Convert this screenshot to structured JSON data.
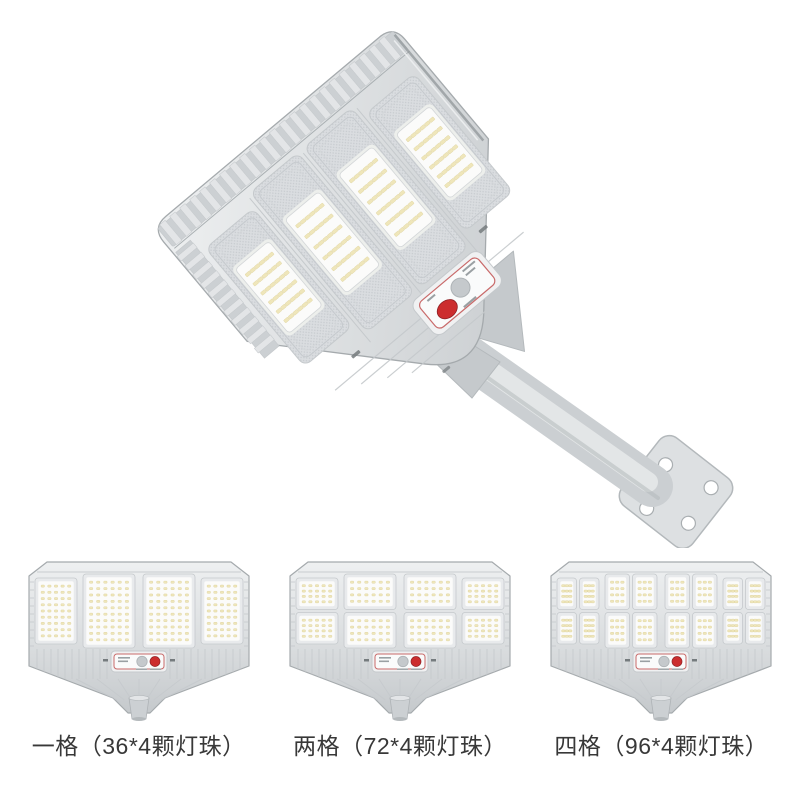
{
  "background": "#ffffff",
  "colors": {
    "body": "#d8dbdd",
    "body_shade": "#c5c9cc",
    "body_dark": "#aab0b3",
    "body_light": "#eef0f1",
    "outline": "#a5aaad",
    "rim_slot": "#8d9396",
    "fin_light": "#e3e5e7",
    "fin_band": "#ccd0d3",
    "knurl_bg": "#dadde0",
    "knurl_dot": "#c6cace",
    "module_frame": "#e8eaec",
    "module_glow": "#edefec",
    "reflector_white": "#fbfbfa",
    "led_chip": "#efe6ba",
    "led_chip_edge": "#d9cd92",
    "control_bg": "#f0f1f2",
    "control_inner": "#fafbfb",
    "control_border_red": "#c96a6a",
    "button_red": "#cc2d2e",
    "button_red_edge": "#8f2125",
    "sensor_gray": "#c5c9cc",
    "sensor_edge": "#aeb3b6",
    "text_tick": "#9aa0a3",
    "slot_dark": "#757b7e",
    "pole_base": "#cbcfd2",
    "pole_light": "#e5e8e9",
    "pole_dark": "#b4b9bc",
    "plate": "#dde0e2",
    "plate_edge": "#b3b8bb",
    "label_text": "#383838"
  },
  "main_figure": {
    "panels": 4,
    "led_grid": {
      "cols": 6,
      "rows": 6
    },
    "has_mount_arm": true,
    "has_control_panel": true
  },
  "variants": [
    {
      "label": "一格（36*4颗灯珠）",
      "panel_rows": 1,
      "panel_cols": 1
    },
    {
      "label": "两格（72*4颗灯珠）",
      "panel_rows": 2,
      "panel_cols": 1
    },
    {
      "label": "四格（96*4颗灯珠）",
      "panel_rows": 2,
      "panel_cols": 2
    }
  ]
}
